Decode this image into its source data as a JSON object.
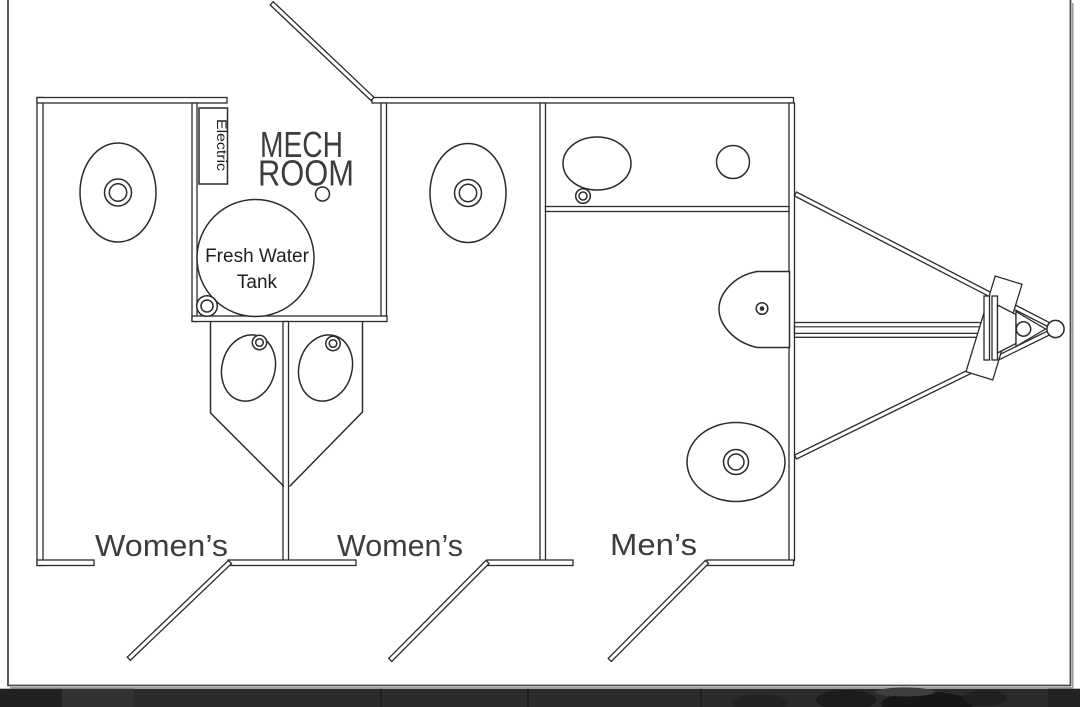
{
  "drawing": {
    "type": "restroom-trailer floor plan",
    "mech_room": {
      "line1": "MECH",
      "line2": "ROOM"
    },
    "electric_panel": {
      "label": "Electric"
    },
    "fresh_water_tank": {
      "line1": "Fresh Water",
      "line2": "Tank"
    },
    "room_labels": {
      "womens_left": "Women’s",
      "womens_middle": "Women’s",
      "mens": "Men’s"
    }
  },
  "colors": {
    "paper": "#ffffff",
    "ink": "#2b2b2b",
    "cad_label_text": "#3d3d3d",
    "page_border": "#4a4a4a",
    "border_shadow": "#a0a0a0",
    "bottom_bar": "#2b2b2b"
  }
}
